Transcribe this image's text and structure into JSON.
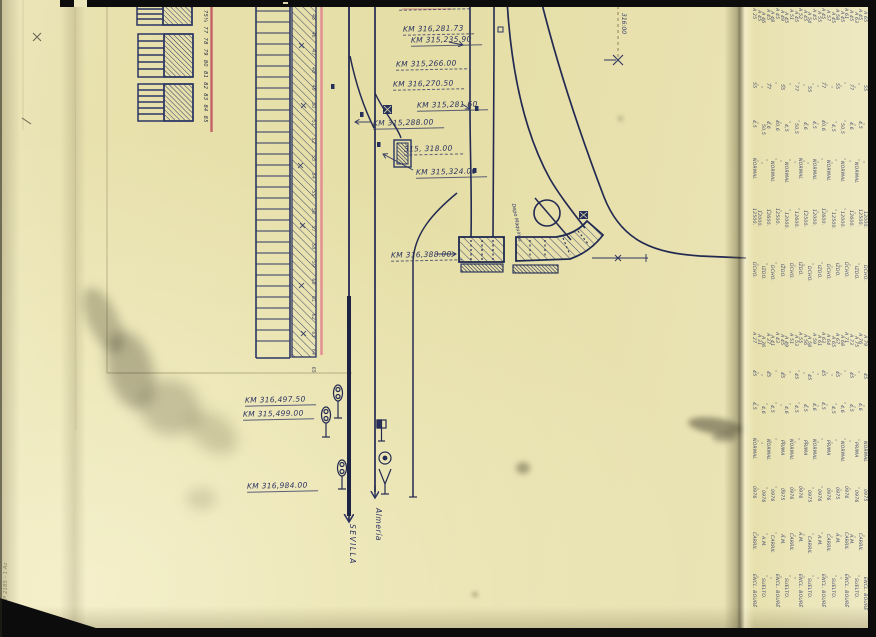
{
  "colors": {
    "ink": "#2b3261",
    "ink_heavy": "#1d2443",
    "red_line": "#c0545e",
    "pink_line": "#e2848f",
    "pencil": "#8b8568",
    "paper": "#e8e1ae",
    "paper_right_sheet": "#ece6bc",
    "border_black": "#0c0c0c"
  },
  "labels": {
    "km": [
      {
        "text": "KM 316,214.90",
        "x": 399,
        "y": -1,
        "u": "dashed"
      },
      {
        "text": "KM 316,281.73",
        "x": 403,
        "y": 24,
        "u": "dashed"
      },
      {
        "text": "KM 315,235.90",
        "x": 411,
        "y": 35,
        "u": "solid"
      },
      {
        "text": "KM 315,266.00",
        "x": 396,
        "y": 59,
        "u": "dashed"
      },
      {
        "text": "KM 316,270.50",
        "x": 393,
        "y": 79,
        "u": "dashed"
      },
      {
        "text": "KM 315,281.60",
        "x": 417,
        "y": 100,
        "u": "solid"
      },
      {
        "text": "KM 315,288.00",
        "x": 373,
        "y": 118,
        "u": "solid"
      },
      {
        "text": "315, 318.00",
        "x": 404,
        "y": 144,
        "u": "dashed"
      },
      {
        "text": "KM 315,324.00",
        "x": 416,
        "y": 167,
        "u": "solid"
      },
      {
        "text": "KM 316,388.00",
        "x": 391,
        "y": 250,
        "u": "dashed"
      },
      {
        "text": "KM 316,497.50",
        "x": 245,
        "y": 395,
        "u": "solid"
      },
      {
        "text": "KM 315,499.00",
        "x": 243,
        "y": 409,
        "u": "solid"
      },
      {
        "text": "KM 316,984.00",
        "x": 247,
        "y": 481,
        "u": "solid"
      }
    ],
    "sevilla": "SEVILLA",
    "almeria": "Almería",
    "marker316": "316:00",
    "depot": "Depo Maquinas",
    "red_numbers": "75¼ 77 78 79 80 81 82 83 84 85",
    "platform_numbers": "45 46 47 48 49 50 51 52 53 54 55 56 57 58 59 60 61 62 63 64 65",
    "margin_note": "3m Nº 2185 - 1 Az"
  },
  "right_table": {
    "rows": [
      {
        "cells": [
          "A 25",
          "55",
          "4,5",
          "NORMAL",
          "12500.",
          "DCHO.",
          "A 27",
          "45",
          "4,5",
          "NORMAL",
          "0976",
          "CARRIL",
          "ENCL. BOURÉ"
        ]
      },
      {
        "cells": [
          "A 45",
          "„",
          "„",
          "„",
          "12000.",
          "„",
          "A 31",
          "„",
          "„",
          "„",
          "„",
          "„",
          "„"
        ]
      },
      {
        "cells": [
          "A 46",
          "„",
          "50,5",
          "„",
          "„",
          "IZDO.",
          "A 36",
          "„",
          "4,6",
          "„",
          "0976",
          "A.M.",
          "SUELTO."
        ]
      },
      {
        "cells": [
          "A 45",
          "77",
          "4,6",
          "„",
          "12600.",
          "„",
          "A 37",
          "45",
          "„",
          "NORMAL",
          "„",
          "„",
          "„"
        ]
      },
      {
        "cells": [
          "A 48",
          "„",
          "„",
          "NORMAL",
          "„",
          "DCHO.",
          "A 41",
          "„",
          "4,5",
          "„",
          "0976",
          "CARRIL",
          "„"
        ]
      },
      {
        "cells": [
          "A 45",
          "„",
          "40,6",
          "„",
          "12500.",
          "„",
          "A 43",
          "„",
          "„",
          "„",
          "„",
          "„",
          "ENCL. BOURÉ"
        ]
      },
      {
        "cells": [
          "A 49",
          "55",
          "„",
          "„",
          "„",
          "IZDO.",
          "A 45",
          "45",
          "„",
          "PRIMA",
          "0975",
          "A.M.",
          "„"
        ]
      },
      {
        "cells": [
          "A 45",
          "„",
          "4,5",
          "NORMAL",
          "12000.",
          "„",
          "A 49",
          "„",
          "4,6",
          "„",
          "„",
          "„",
          "SUELTO."
        ]
      },
      {
        "cells": [
          "A 51",
          "„",
          "„",
          "„",
          "„",
          "DCHO.",
          "A 51",
          "„",
          "„",
          "NORMAL",
          "0976",
          "CARRIL",
          "„"
        ]
      },
      {
        "cells": [
          "A 45",
          "77",
          "50,5",
          "„",
          "12600.",
          "„",
          "A 53",
          "45",
          "4,5",
          "„",
          "„",
          "„",
          "„"
        ]
      },
      {
        "cells": [
          "A 52",
          "„",
          "„",
          "NORMAL",
          "„",
          "IZDO.",
          "A 55",
          "„",
          "„",
          "„",
          "0976",
          "A.M.",
          "ENCL. BOURÉ"
        ]
      },
      {
        "cells": [
          "A 45",
          "„",
          "4,6",
          "„",
          "12500.",
          "„",
          "A 56",
          "„",
          "4,5",
          "PRIMA",
          "„",
          "„",
          "„"
        ]
      },
      {
        "cells": [
          "A 54",
          "55",
          "„",
          "„",
          "„",
          "DCHO.",
          "A 58",
          "45",
          "„",
          "„",
          "0975",
          "CARRIL",
          "SUELTO."
        ]
      },
      {
        "cells": [
          "A 45",
          "„",
          "4,5",
          "NORMAL",
          "12000.",
          "„",
          "A 59",
          "„",
          "4,6",
          "NORMAL",
          "„",
          "„",
          "„"
        ]
      },
      {
        "cells": [
          "A 55",
          "„",
          "„",
          "„",
          "„",
          "IZDO.",
          "A 61",
          "„",
          "„",
          "„",
          "0976",
          "A.M.",
          "„"
        ]
      },
      {
        "cells": [
          "A 45",
          "77",
          "40,6",
          "„",
          "12600.",
          "„",
          "A 63",
          "45",
          "4,5",
          "„",
          "„",
          "„",
          "ENCL. BOURÉ"
        ]
      },
      {
        "cells": [
          "A 57",
          "„",
          "„",
          "NORMAL",
          "„",
          "DCHO.",
          "A 64",
          "„",
          "„",
          "PRIMA",
          "0976",
          "CARRIL",
          "„"
        ]
      },
      {
        "cells": [
          "A 45",
          "„",
          "4,5",
          "„",
          "12500.",
          "„",
          "A 65",
          "„",
          "4,5",
          "„",
          "„",
          "„",
          "SUELTO."
        ]
      },
      {
        "cells": [
          "A 58",
          "55",
          "„",
          "„",
          "„",
          "IZDO.",
          "A 67",
          "45",
          "„",
          "„",
          "0975",
          "A.M.",
          "„"
        ]
      },
      {
        "cells": [
          "A 45",
          "„",
          "50,5",
          "NORMAL",
          "12000.",
          "„",
          "A 68",
          "„",
          "4,6",
          "NORMAL",
          "„",
          "„",
          "„"
        ]
      },
      {
        "cells": [
          "A 61",
          "„",
          "„",
          "„",
          "„",
          "DCHO.",
          "A 71",
          "„",
          "„",
          "„",
          "0976",
          "CARRIL",
          "ENCL. BOURÉ"
        ]
      },
      {
        "cells": [
          "A 45",
          "77",
          "4,6",
          "„",
          "12600.",
          "„",
          "A 73",
          "45",
          "4,5",
          "„",
          "„",
          "A.M.",
          "„"
        ]
      },
      {
        "cells": [
          "A 63",
          "„",
          "„",
          "NORMAL",
          "„",
          "IZDO.",
          "A 75",
          "„",
          "„",
          "PRIMA",
          "0976",
          "„",
          "SUELTO."
        ]
      },
      {
        "cells": [
          "A 45",
          "„",
          "4,5",
          "„",
          "12500.",
          "„",
          "A 76",
          "„",
          "4,6",
          "„",
          "„",
          "CARRIL",
          "„"
        ]
      },
      {
        "cells": [
          "A 65",
          "55",
          "„",
          "„",
          "12000.",
          "DCHO.",
          "A 79",
          "45",
          "„",
          "NORMAL",
          "0975",
          "„",
          "ENCL. BOURÉ"
        ]
      }
    ]
  }
}
